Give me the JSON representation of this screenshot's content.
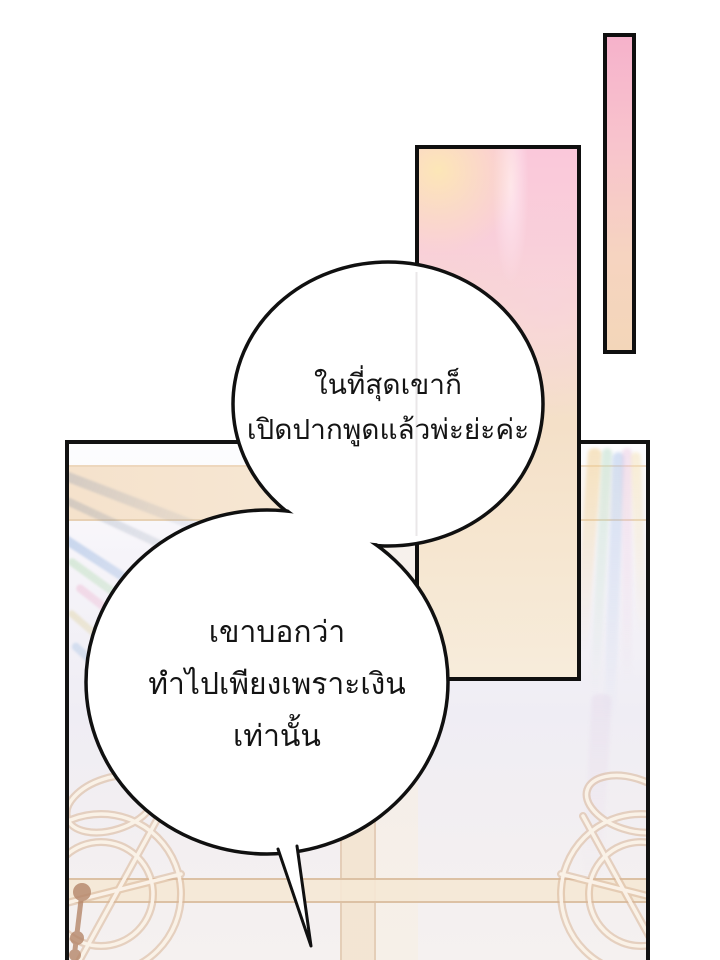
{
  "page_type": "webtoon-comic-panel",
  "speech_bubbles": {
    "top": {
      "lines": [
        "ในที่สุดเขาก็",
        "เปิดปากพูดแล้วพ่ะย่ะค่ะ"
      ]
    },
    "bottom": {
      "lines": [
        "เขาบอกว่า",
        "ทำไปเพียงเพราะเงิน",
        "เท่านั้น"
      ]
    }
  },
  "colors": {
    "outline_black": "#101010",
    "bubble_fill": "#ffffff",
    "pink_strong": "#f6b2cb",
    "pink_soft": "#f9cfd9",
    "peach_cream": "#f6e6d0",
    "ceiling_cream": "#f5e2cc",
    "wood_tan": "#d9b698",
    "knob_brown": "#b5866a",
    "wall_lavender": "#efedf4"
  }
}
